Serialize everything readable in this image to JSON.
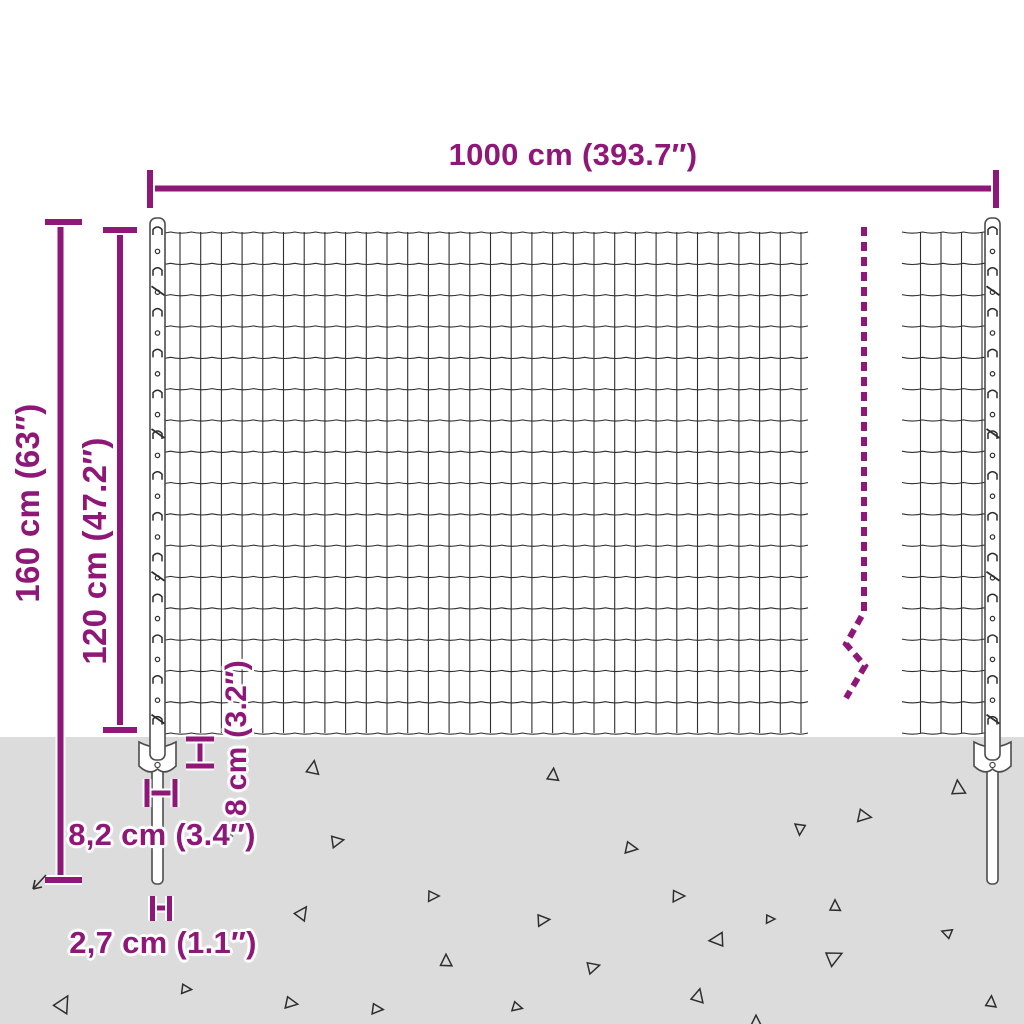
{
  "diagram": {
    "name": "wire-mesh-fence-dimension-diagram",
    "dimensions": {
      "total_width": "1000 cm (393.7″)",
      "total_height": "160 cm (63″)",
      "panel_height": "120 cm (47.2″)",
      "anchor_plate_depth": "8 cm (3.2″)",
      "anchor_plate_width": "8,2 cm (3.4″)",
      "spike_width": "2,7 cm (1.1″)"
    },
    "colors": {
      "accent": "#8e1777",
      "ground": "#dcdcdc",
      "wire": "#2e2e2e",
      "steel_outline": "#4d4d4d",
      "steel_fill": "#ffffff",
      "background": "#ffffff"
    }
  }
}
